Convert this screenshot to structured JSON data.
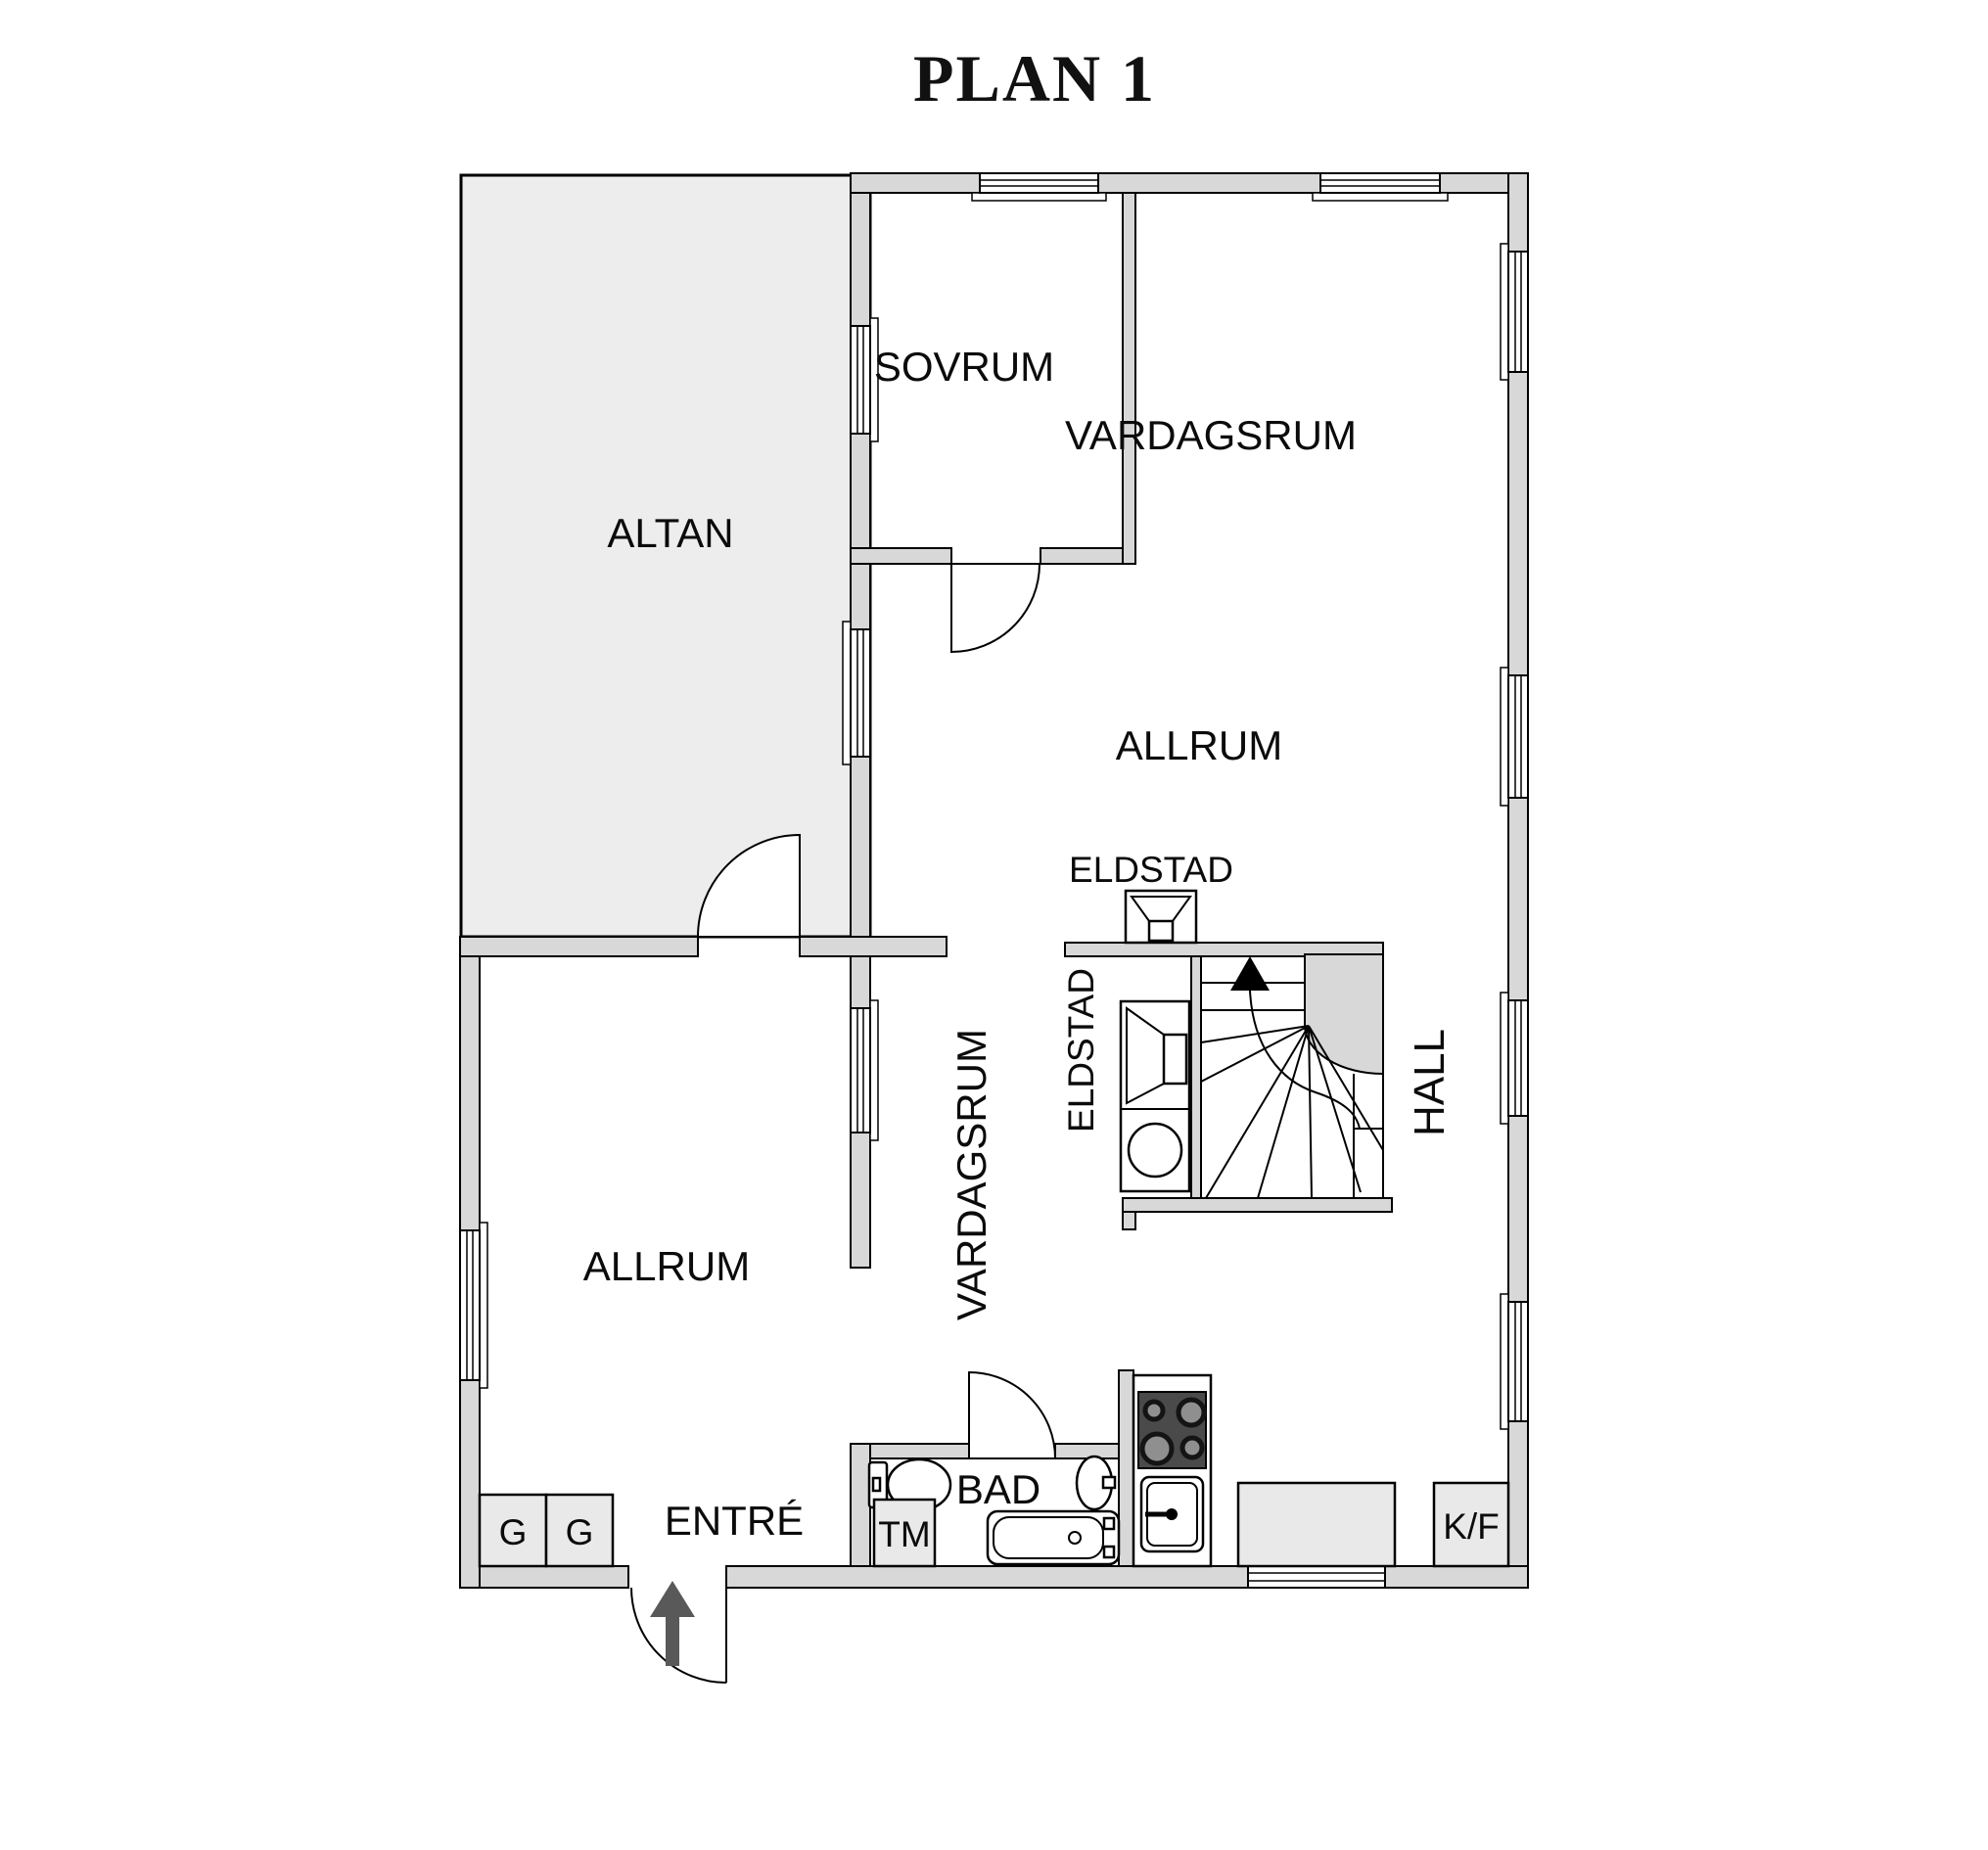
{
  "title": "PLAN 1",
  "floorplan": {
    "rooms": {
      "altan": "ALTAN",
      "sovrum": "SOVRUM",
      "vardagsrum_top": "VARDAGSRUM",
      "allrum_center": "ALLRUM",
      "eldstad_top": "ELDSTAD",
      "eldstad_left": "ELDSTAD",
      "hall": "HALL",
      "allrum_lower": "ALLRUM",
      "vardagsrum_lower": "VARDAGSRUM",
      "entre": "ENTRÉ",
      "bad": "BAD"
    },
    "fixtures": {
      "wardrobe_1": "G",
      "wardrobe_2": "G",
      "washing_machine": "TM",
      "fridge_freezer": "K/F"
    },
    "colors": {
      "wall_fill": "#d8d8d8",
      "terrace_fill": "#ededed",
      "room_fill": "#ffffff",
      "cooktop": "#4a4a4a",
      "entry_arrow": "#595959",
      "outline": "#000000"
    }
  }
}
